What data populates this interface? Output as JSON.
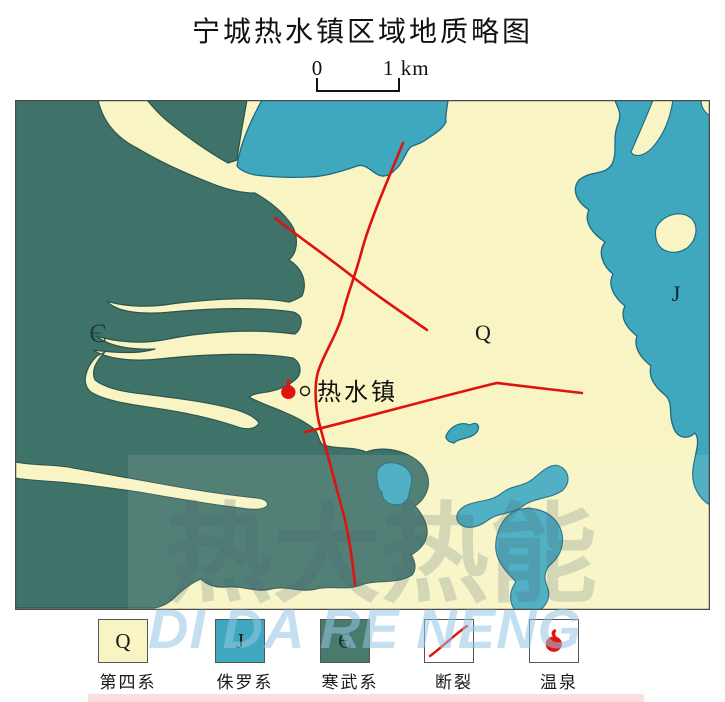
{
  "title": "宁城热水镇区域地质略图",
  "scale_bar": {
    "start_label": "0",
    "end_label": "1 km"
  },
  "map": {
    "region_labels": {
      "cambrian": "Є",
      "quaternary": "Q",
      "jurassic": "J"
    },
    "town": {
      "name": "热水镇"
    }
  },
  "legend": {
    "items": [
      {
        "symbol": "Q",
        "label": "第四系",
        "color": "#F8F4C3"
      },
      {
        "symbol": "J",
        "label": "侏罗系",
        "color": "#3FA7BE"
      },
      {
        "symbol": "Є",
        "label": "寒武系",
        "color": "#4A7A6E"
      },
      {
        "symbol": "fault-line",
        "label": "断裂",
        "color": "#DE1310"
      },
      {
        "symbol": "hot-spring",
        "label": "温泉",
        "color": "#E01410"
      }
    ]
  },
  "watermark": {
    "line1": "热大热能",
    "line2": "DI DA RE NENG"
  },
  "colors": {
    "quaternary_fill": "#F8F4C3",
    "jurassic_fill": "#3FA7BE",
    "cambrian_fill": "#3F7268",
    "fault_red": "#DE1310",
    "hot_spring_red": "#E01410",
    "map_border": "#4a4a4a"
  }
}
